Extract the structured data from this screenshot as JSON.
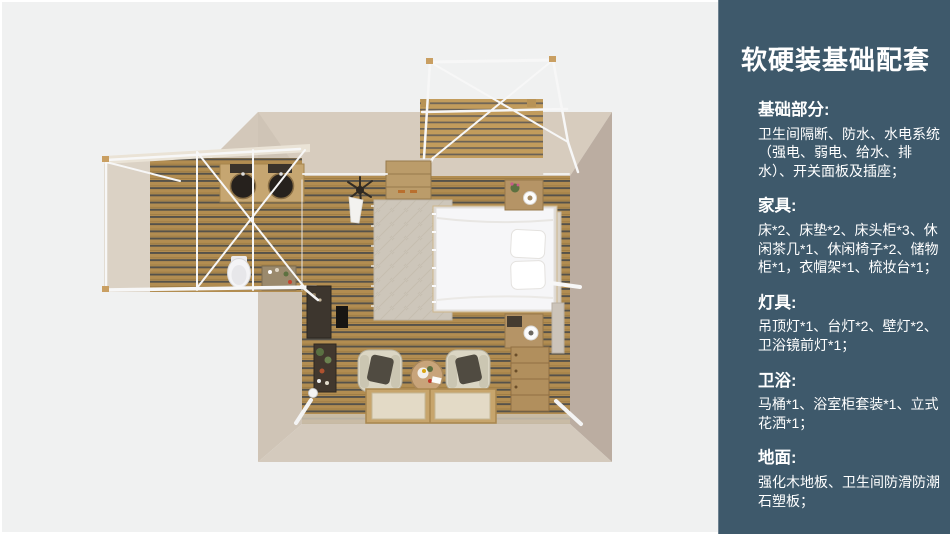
{
  "colors": {
    "page_background": "#f0f1f1",
    "panel_background": "#3e596b",
    "panel_text": "#ffffff",
    "wood_floor": "#b28d51",
    "wood_gap": "#55524a",
    "wall_beige": "#d3c8ba",
    "wall_shadow": "#bbada1",
    "white_frame": "#f7f7f7",
    "furniture_wood": "#b59466"
  },
  "panel": {
    "title": "软硬装基础配套",
    "sections": [
      {
        "heading": "基础部分:",
        "body": "卫生间隔断、防水、水电系统（强电、弱电、给水、排水）、开关面板及插座；"
      },
      {
        "heading": "家具:",
        "body": "床*2、床垫*2、床头柜*3、休闲茶几*1、休闲椅子*2、储物柜*1，衣帽架*1、梳妆台*1；"
      },
      {
        "heading": "灯具:",
        "body": "吊顶灯*1、台灯*2、壁灯*2、卫浴镜前灯*1；"
      },
      {
        "heading": "卫浴:",
        "body": "马桶*1、浴室柜套装*1、立式花洒*1；"
      },
      {
        "heading": "地面:",
        "body": "强化木地板、卫生间防滑防潮石塑板；"
      }
    ]
  },
  "floorplan": {
    "view": "top-down-3d-render",
    "elements": [
      "balcony-frame",
      "balcony-deck",
      "bedroom",
      "bathroom",
      "open-deck",
      "bed",
      "pillows",
      "nightstand",
      "rug",
      "wardrobe",
      "hanging-plant",
      "hanging-garment",
      "armchair",
      "coffee-table",
      "floor-mats",
      "chest-of-drawers",
      "dressing-table",
      "tv-panel",
      "plant-shelf",
      "floor-lamp",
      "bathroom-counter",
      "sink",
      "toilet",
      "vanity",
      "door-handle",
      "headboard"
    ]
  }
}
